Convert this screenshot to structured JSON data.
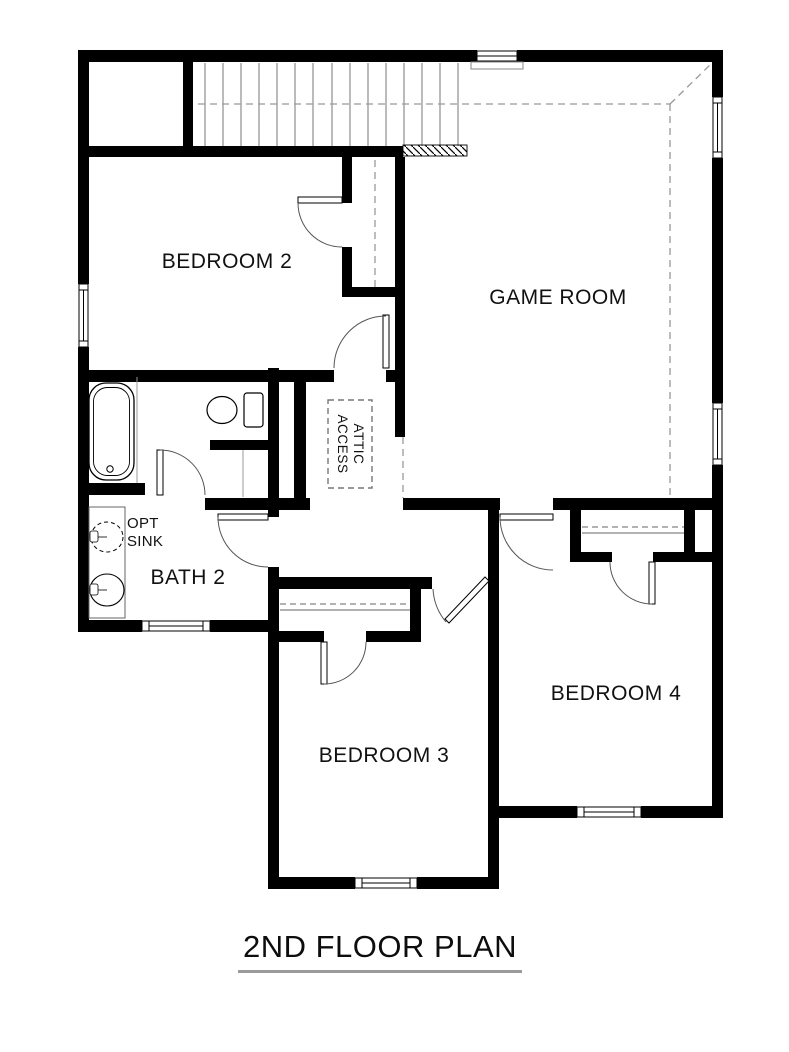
{
  "title": {
    "text": "2ND FLOOR PLAN"
  },
  "rooms": {
    "bedroom2": {
      "label": "BEDROOM 2"
    },
    "game_room": {
      "label": "GAME ROOM"
    },
    "bath2": {
      "label": "BATH 2"
    },
    "bedroom3": {
      "label": "BEDROOM 3"
    },
    "bedroom4": {
      "label": "BEDROOM 4"
    }
  },
  "annotations": {
    "attic_access": {
      "line1": "ATTIC",
      "line2": "ACCESS"
    },
    "opt_sink": {
      "line1": "OPT",
      "line2": "SINK"
    }
  },
  "fixtures": [
    {
      "name": "staircase"
    },
    {
      "name": "bathtub"
    },
    {
      "name": "toilet"
    },
    {
      "name": "optional-sink"
    },
    {
      "name": "vanity-sink"
    }
  ],
  "colors": {
    "wall": "#000000",
    "thin_line": "#777777",
    "dashed_line": "#999999",
    "label_text": "#111111",
    "title_underline": "#9b9b9b",
    "background": "#ffffff"
  }
}
